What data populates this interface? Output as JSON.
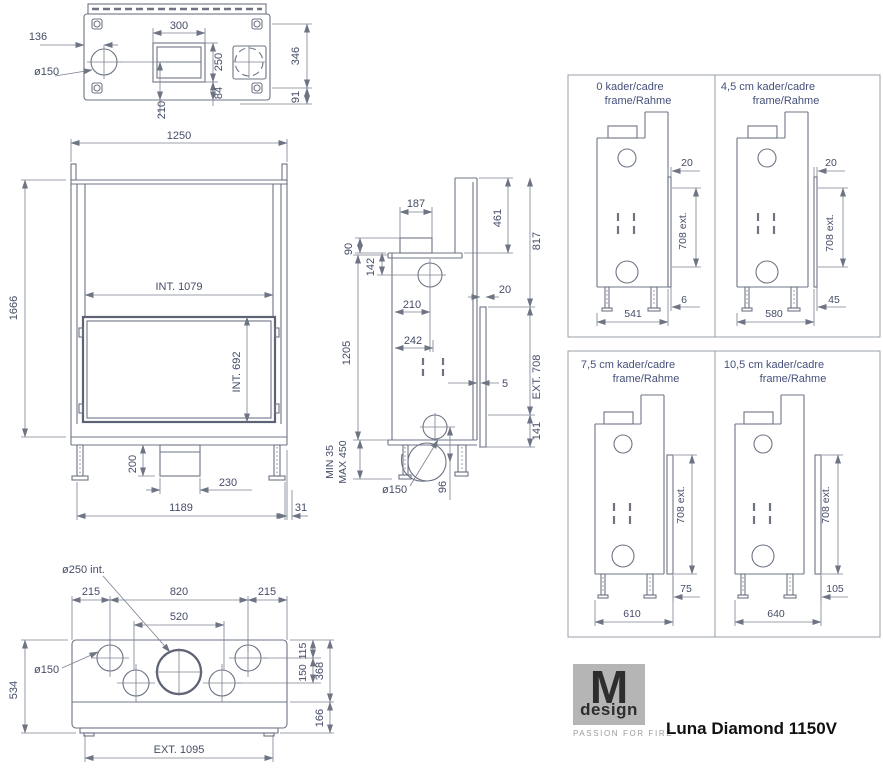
{
  "logo": {
    "brand": "M",
    "brand_sub": "design",
    "tagline": "PASSION FOR FIRE",
    "model": "Luna Diamond 1150V"
  },
  "views": {
    "top": {
      "d136": "136",
      "dia150": "ø150",
      "d300": "300",
      "d250": "250",
      "d84": "84",
      "d346": "346",
      "d91": "91",
      "d210": "210"
    },
    "front": {
      "d1250": "1250",
      "d1666": "1666",
      "int1079": "INT. 1079",
      "int692": "INT. 692",
      "d200": "200",
      "d230": "230",
      "d1189": "1189",
      "d31": "31"
    },
    "side": {
      "d187": "187",
      "d90": "90",
      "d142": "142",
      "d461": "461",
      "d817": "817",
      "d20": "20",
      "d210": "210",
      "d242": "242",
      "d1205": "1205",
      "d5": "5",
      "ext708": "EXT. 708",
      "d141": "141",
      "min35": "MIN 35",
      "max450": "MAX 450",
      "dia150": "ø150",
      "d96": "96"
    },
    "bottom": {
      "dia250": "ø250 int.",
      "d215l": "215",
      "d820": "820",
      "d215r": "215",
      "d520": "520",
      "dia150": "ø150",
      "d534": "534",
      "d115": "115",
      "d150": "150",
      "d368": "368",
      "d166": "166",
      "ext1095": "EXT. 1095"
    }
  },
  "frame_variants": [
    {
      "title": "0  kader/cadre",
      "subtitle": "frame/Rahme",
      "gap_dim": "20",
      "ext_dim": "708 ext.",
      "offset_dim": "6",
      "base_dim": "541"
    },
    {
      "title": "4,5 cm  kader/cadre",
      "subtitle": "frame/Rahme",
      "gap_dim": "20",
      "ext_dim": "708 ext.",
      "offset_dim": "45",
      "base_dim": "580"
    },
    {
      "title": "7,5 cm kader/cadre",
      "subtitle": "frame/Rahme",
      "ext_dim": "708 ext.",
      "offset_dim": "75",
      "base_dim": "610"
    },
    {
      "title": "10,5 cm kader/cadre",
      "subtitle": "frame/Rahme",
      "ext_dim": "708 ext.",
      "offset_dim": "105",
      "base_dim": "640"
    }
  ]
}
